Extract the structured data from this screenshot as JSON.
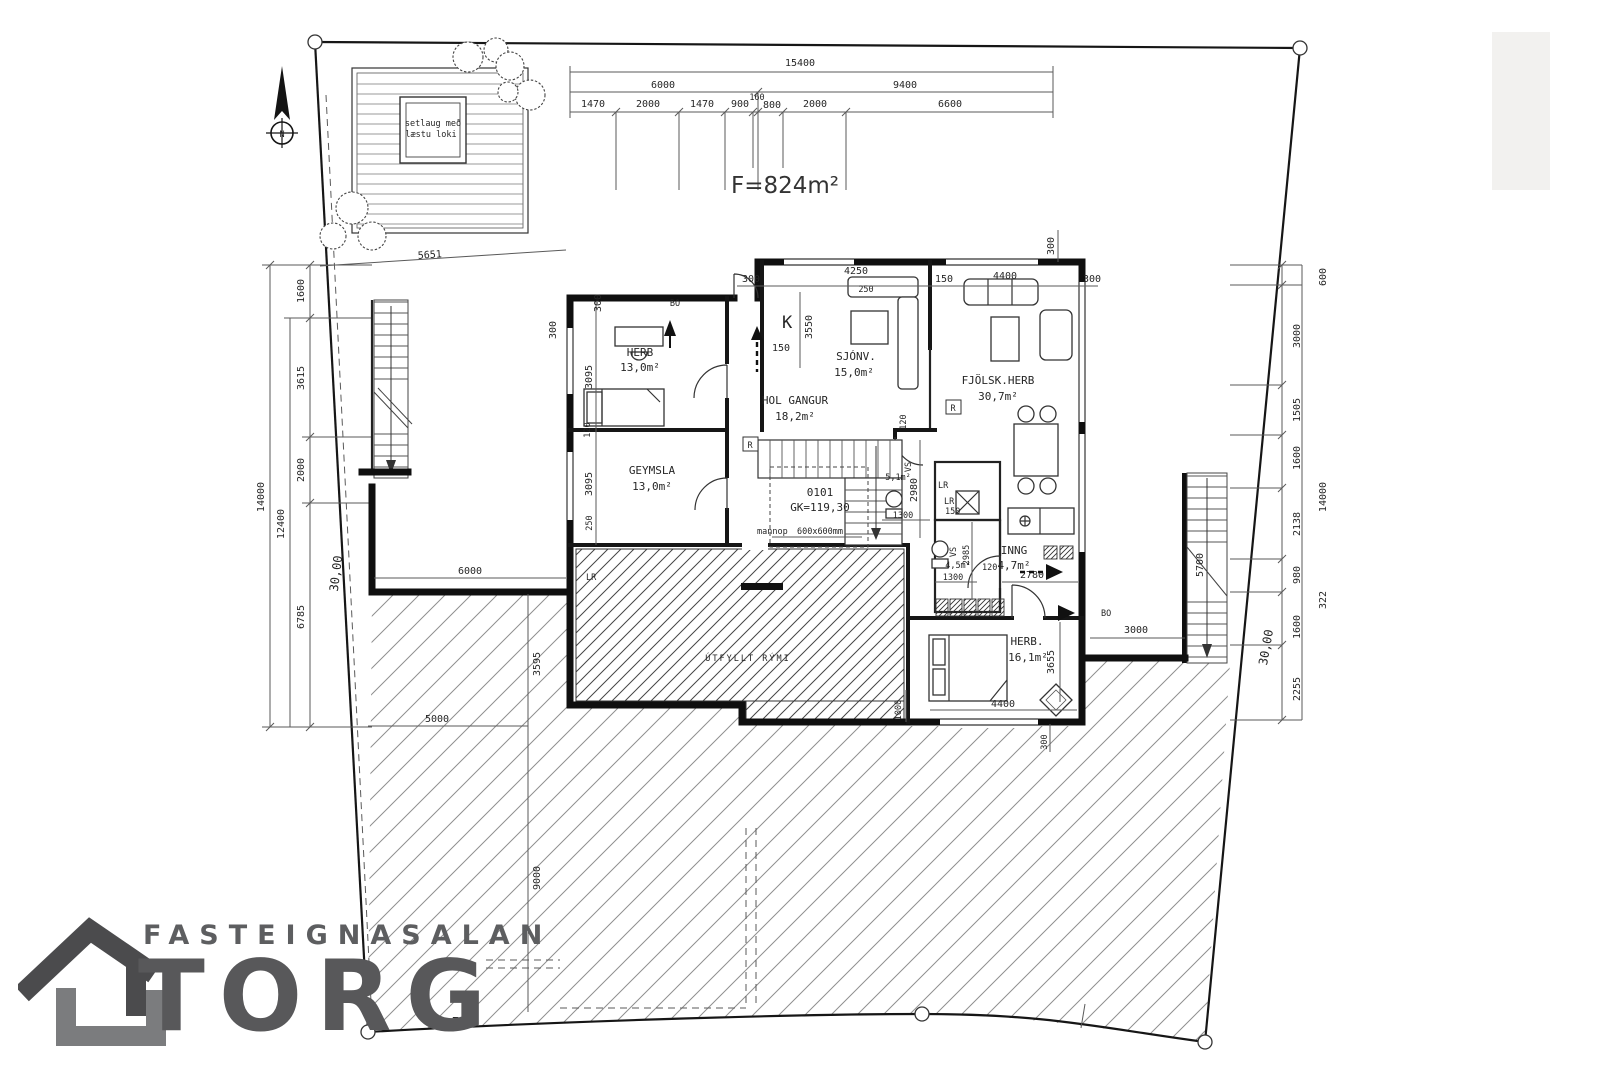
{
  "site": {
    "area": "F=824m²",
    "north": "N",
    "hot_tub_line1": "setlaug með",
    "hot_tub_line2": "læstu loki",
    "boundary_left": "30,00",
    "boundary_right": "30,00",
    "diag": "5651",
    "corner": "7,9"
  },
  "top_chain": {
    "total": "15400",
    "a": "6000",
    "b": "9400",
    "s1": "1470",
    "s2": "2000",
    "s3": "1470",
    "s4": "900",
    "s5": "160",
    "s6": "800",
    "s7": "2000",
    "s8": "6600"
  },
  "left_chain": {
    "overall": "14000",
    "mid": "12400",
    "s1": "1600",
    "s2": "3615",
    "s3": "2000",
    "s4": "6785"
  },
  "right_chain": {
    "top": "600",
    "overall": "14000",
    "extra": "322",
    "s1": "3000",
    "s2": "1505",
    "s3": "1600",
    "s4": "2138",
    "s5": "980",
    "s6": "1600",
    "s7": "2255"
  },
  "house_top": {
    "d1": "300",
    "d2": "4250",
    "d3": "150",
    "d4": "4400",
    "d5": "300",
    "d6": "300",
    "d7": "250"
  },
  "rooms": {
    "herb1": {
      "name": "HERB",
      "area": "13,0m²"
    },
    "geymsla": {
      "name": "GEYMSLA",
      "area": "13,0m²"
    },
    "hol": {
      "name": "HOL GANGUR",
      "area": "18,2m²"
    },
    "sjonv": {
      "name": "SJÓNV.",
      "area": "15,0m²"
    },
    "fjolsk": {
      "name": "FJÖLSK.HERB",
      "area": "30,7m²"
    },
    "vs1": {
      "name": "VS",
      "area": "5,1m²"
    },
    "bath": {
      "name": "VS",
      "area": "4,5m²"
    },
    "inng": {
      "name": "INNG",
      "area": "4,7m²"
    },
    "herb2": {
      "name": "HERB.",
      "area": "16,1m²"
    },
    "utfyllt": {
      "name": "ÚTFYLLT RÝMI"
    }
  },
  "unit": {
    "code": "0101",
    "gk": "GK=119,30",
    "mannop": "mannop",
    "mannop_size": "600x600mm"
  },
  "hd": {
    "w300a": "300",
    "w300b": "300",
    "v3095a": "3095",
    "v120": "120",
    "v3095b": "3095",
    "v250": "250",
    "k": "K",
    "k3550": "3550",
    "up150": "150",
    "st120": "120",
    "v2980": "2980",
    "w1300a": "1300",
    "lr_a": "LR",
    "lr_b": "LR",
    "lr_c": "LR",
    "lr150": "150",
    "b1300": "1300",
    "b120": "120",
    "b2985": "2985",
    "i2780": "2780",
    "h4400": "4400",
    "h3655": "3655",
    "h300": "300",
    "h1000": "1000",
    "bo1": "BO",
    "bo2": "BO",
    "r1": "R",
    "r2": "R",
    "p6000": "6000",
    "p3595": "3595",
    "p5000": "5000",
    "p9000": "9000",
    "s5700": "5700",
    "s3000": "3000"
  },
  "logo": {
    "line1": "FASTEIGNASALAN",
    "line2": "TORG"
  }
}
